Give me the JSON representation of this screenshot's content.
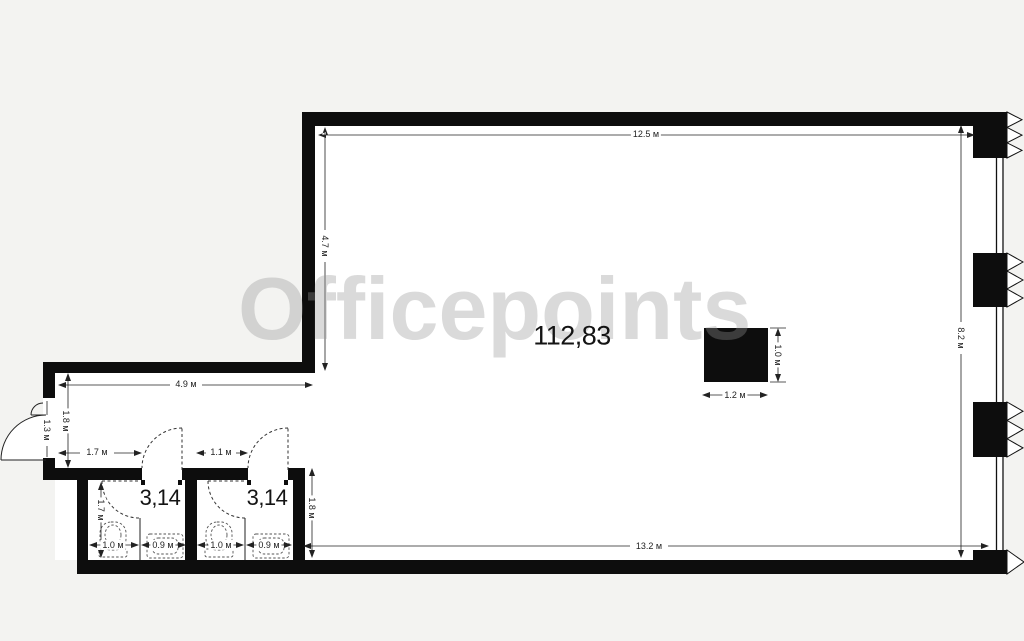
{
  "watermark": {
    "text": "Officepoints"
  },
  "rooms": {
    "main": {
      "area_label": "112,83"
    },
    "wc1": {
      "area_label": "3,14"
    },
    "wc2": {
      "area_label": "3,14"
    }
  },
  "dimensions": {
    "top_width": "12.5 м",
    "upper_left_height": "4.7 м",
    "right_height": "8.2 м",
    "vestibule_width": "4.9 м",
    "vestibule_height": "1.8 м",
    "entry_door_width": "1.3 м",
    "wc1_door_offset": "1.7 м",
    "wc2_door_offset": "1.1 м",
    "wc1_depth": "1.7 м",
    "lower_section_height": "1.8 м",
    "wc1_toilet_width": "1.0 м",
    "wc1_sink_width": "0.9 м",
    "wc2_toilet_width": "1.0 м",
    "wc2_sink_width": "0.9 м",
    "bottom_width": "13.2 м",
    "column_height": "1.0 м",
    "column_width": "1.2 м"
  },
  "colors": {
    "background": "#f3f3f1",
    "walls": "#0d0d0d",
    "interior": "#ffffff",
    "dimension_lines": "#222222",
    "watermark": "#969696"
  }
}
